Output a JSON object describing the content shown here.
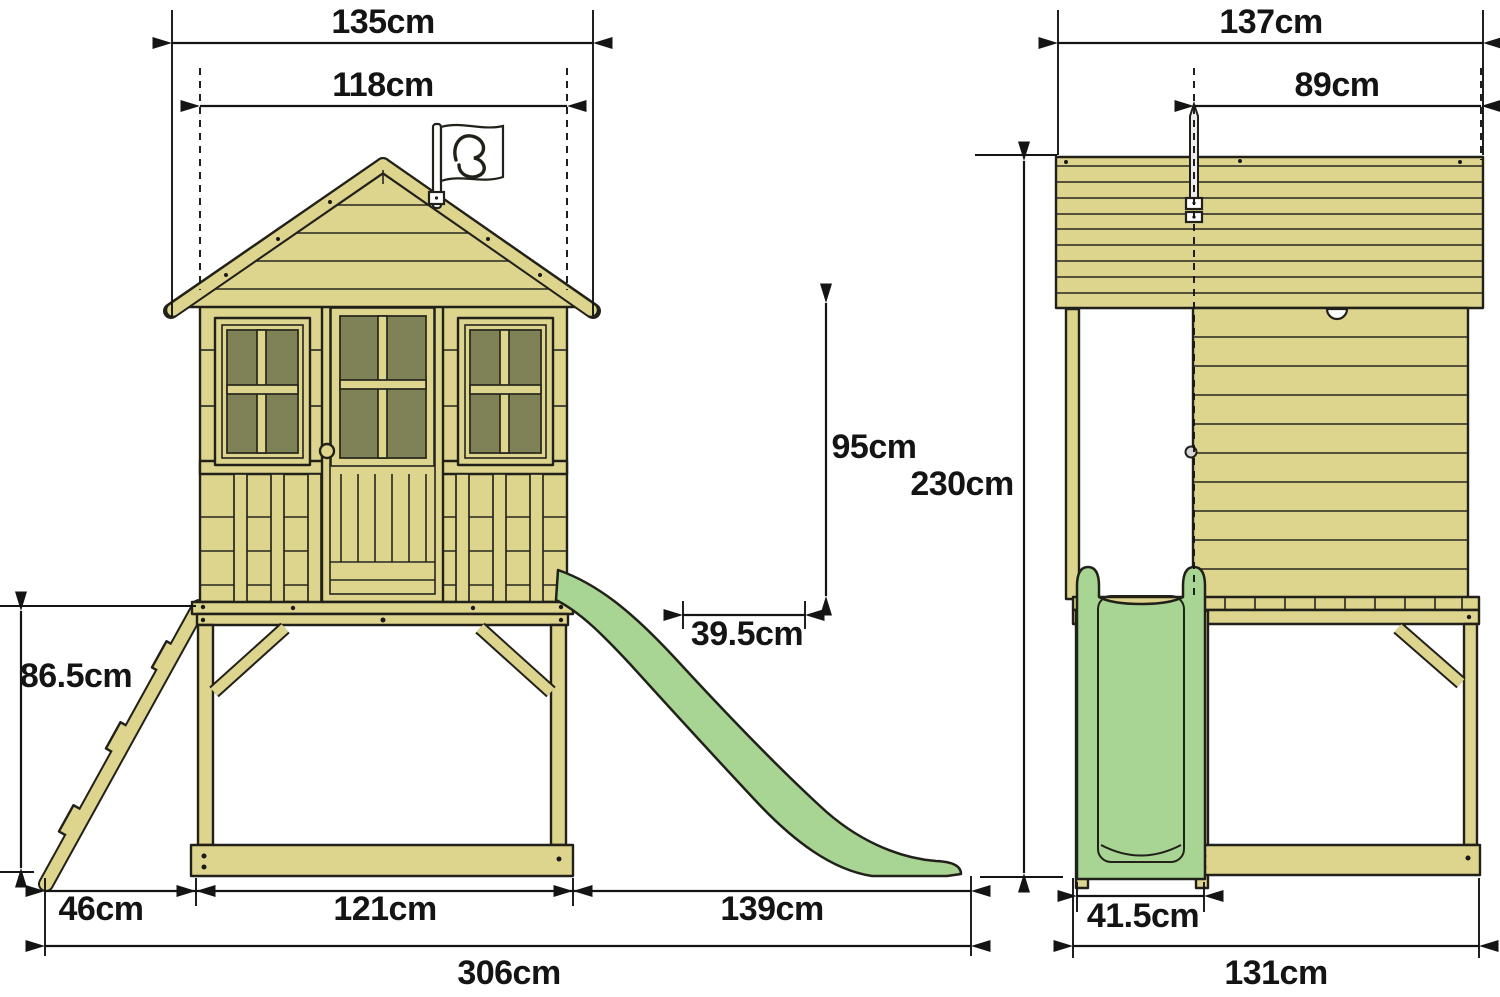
{
  "diagram": {
    "type": "technical-dimension-drawing",
    "unit": "cm",
    "colors": {
      "wood": "#ddd48e",
      "outline": "#21211a",
      "window_glass": "#7f8157",
      "slide_green": "#a8d593",
      "flag_white": "#ffffff",
      "dimension_ink": "#141414",
      "background": "#ffffff"
    },
    "dims": {
      "front_roof_width": {
        "label": "135cm",
        "value": 135
      },
      "front_wall_width": {
        "label": "118cm",
        "value": 118
      },
      "side_door_height": {
        "label": "95cm",
        "value": 95
      },
      "side_door_width": {
        "label": "39.5cm",
        "value": 39.5
      },
      "platform_height": {
        "label": "86.5cm",
        "value": 86.5
      },
      "ladder_footprint_depth": {
        "label": "46cm",
        "value": 46
      },
      "front_base_width": {
        "label": "121cm",
        "value": 121
      },
      "slide_footprint_length": {
        "label": "139cm",
        "value": 139
      },
      "total_footprint_length": {
        "label": "306cm",
        "value": 306
      },
      "side_total_depth": {
        "label": "137cm",
        "value": 137
      },
      "side_roof_depth": {
        "label": "89cm",
        "value": 89
      },
      "total_height": {
        "label": "230cm",
        "value": 230
      },
      "slide_width": {
        "label": "41.5cm",
        "value": 41.5
      },
      "side_base_depth": {
        "label": "131cm",
        "value": 131
      }
    }
  }
}
